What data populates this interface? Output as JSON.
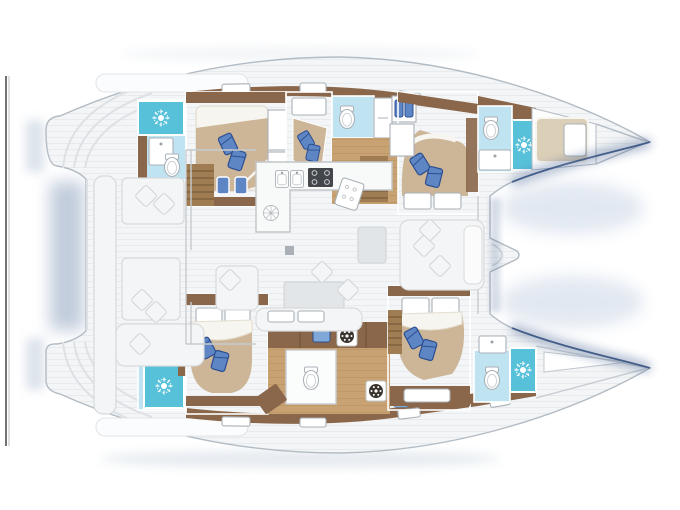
{
  "meta": {
    "type": "yacht-floorplan",
    "subject": "sailing-catamaran-interior-layout",
    "view": "top-down, bow pointing right",
    "no_visible_text": true
  },
  "colors": {
    "page_bg": "#ffffff",
    "frame_line": "#4f4f4f",
    "frame_line_light": "#c2c2c2",
    "hull_stroke": "#b3bcc4",
    "deck": "#f3f5f6",
    "plank": "#e8ebed",
    "wood_wall": "#8a674a",
    "wood_floor": "#c9a273",
    "wood_floor_line": "#b8905f",
    "steps": "#a07c52",
    "step_line": "#6e5334",
    "bed_base": "#cdb698",
    "bed_light": "#dccfb8",
    "sheet": "#f7f5ef",
    "pillow_blue": "#5e86c5",
    "pillow_navy": "#2c4e90",
    "bath_floor": "#bfe3f0",
    "shower": "#57c1da",
    "fixture": "#ffffff",
    "fixture_stroke": "#a9b1b7",
    "seat": "#f4f5f6",
    "seat_stroke": "#d7dadc",
    "gray_furn": "#e2e5e7",
    "stove": "#43474b",
    "navy_shadow": "#3d5a8c",
    "soft_blue": "#8fa3bf"
  },
  "layout": {
    "hull_top_rooms": [
      "transom-steps",
      "aft-shower-room-with-sun-symbol",
      "aft-double-cabin",
      "companionway-steps",
      "mid-double-cabin",
      "mid-bathroom",
      "storage-shelf-with-bottles",
      "forward-double-cabin",
      "forward-bathroom-with-sun-shower",
      "forepeak-berth"
    ],
    "hull_bottom_rooms": [
      "transom-steps",
      "aft-shower-room-with-sun-symbol",
      "aft-double-cabin",
      "utility-area-with-washer-and-separate-wc",
      "forward-double-cabin-with-steps",
      "forward-bathroom-with-sun-shower",
      "bow-locker"
    ],
    "center_rooms": [
      "aft-cockpit-with-seating",
      "saloon",
      "galley-with-twin-sinks-and-stove",
      "sofa-and-table",
      "forward-seating",
      "forward-door",
      "trampoline-area-between-bows"
    ]
  },
  "icons": [
    "sun-shower-icon",
    "toilet-icon",
    "sink-icon",
    "twin-sink-icon",
    "stove-burners-icon",
    "vent-hatch-icon",
    "washer-drum-icon",
    "blue-appliance-icon",
    "pillow-icon",
    "cutting-board-icon"
  ]
}
